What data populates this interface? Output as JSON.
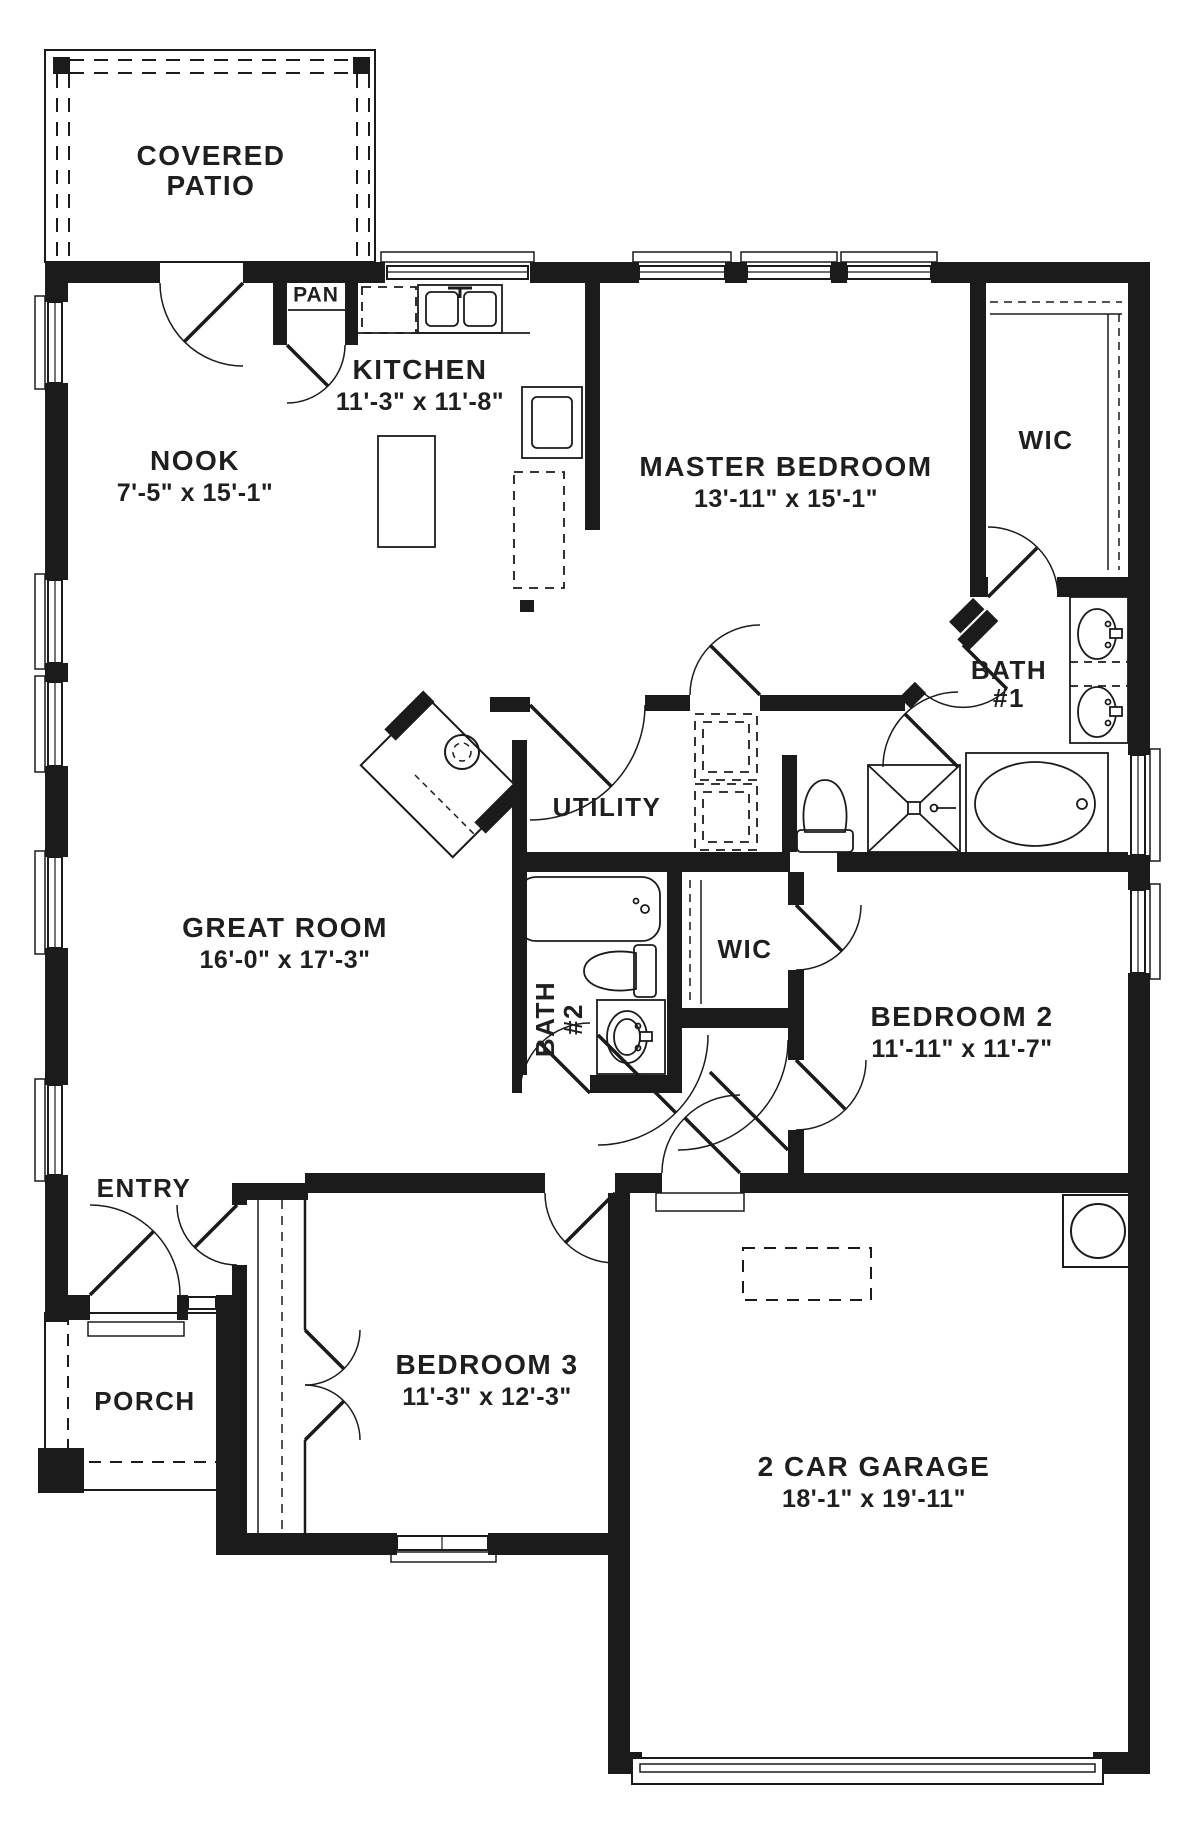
{
  "plan": {
    "colors": {
      "ink": "#1b1b1b",
      "paper": "#ffffff"
    },
    "rooms": {
      "covered_patio": {
        "name": "COVERED\nPATIO",
        "dims": ""
      },
      "pantry": {
        "name": "PAN",
        "dims": ""
      },
      "kitchen": {
        "name": "KITCHEN",
        "dims": "11'-3\" x 11'-8\""
      },
      "nook": {
        "name": "NOOK",
        "dims": "7'-5\" x 15'-1\""
      },
      "master_bedroom": {
        "name": "MASTER BEDROOM",
        "dims": "13'-11\" x 15'-1\""
      },
      "master_wic": {
        "name": "WIC",
        "dims": ""
      },
      "bath_1": {
        "name": "BATH\n#1",
        "dims": ""
      },
      "utility": {
        "name": "UTILITY",
        "dims": ""
      },
      "great_room": {
        "name": "GREAT ROOM",
        "dims": "16'-0\" x 17'-3\""
      },
      "bath_2": {
        "name": "BATH\n#2",
        "dims": ""
      },
      "hall_wic": {
        "name": "WIC",
        "dims": ""
      },
      "bedroom_2": {
        "name": "BEDROOM 2",
        "dims": "11'-11\" x 11'-7\""
      },
      "entry": {
        "name": "ENTRY",
        "dims": ""
      },
      "porch": {
        "name": "PORCH",
        "dims": ""
      },
      "bedroom_3": {
        "name": "BEDROOM 3",
        "dims": "11'-3\" x 12'-3\""
      },
      "garage": {
        "name": "2 CAR GARAGE",
        "dims": "18'-1\" x 19'-11\""
      }
    }
  }
}
